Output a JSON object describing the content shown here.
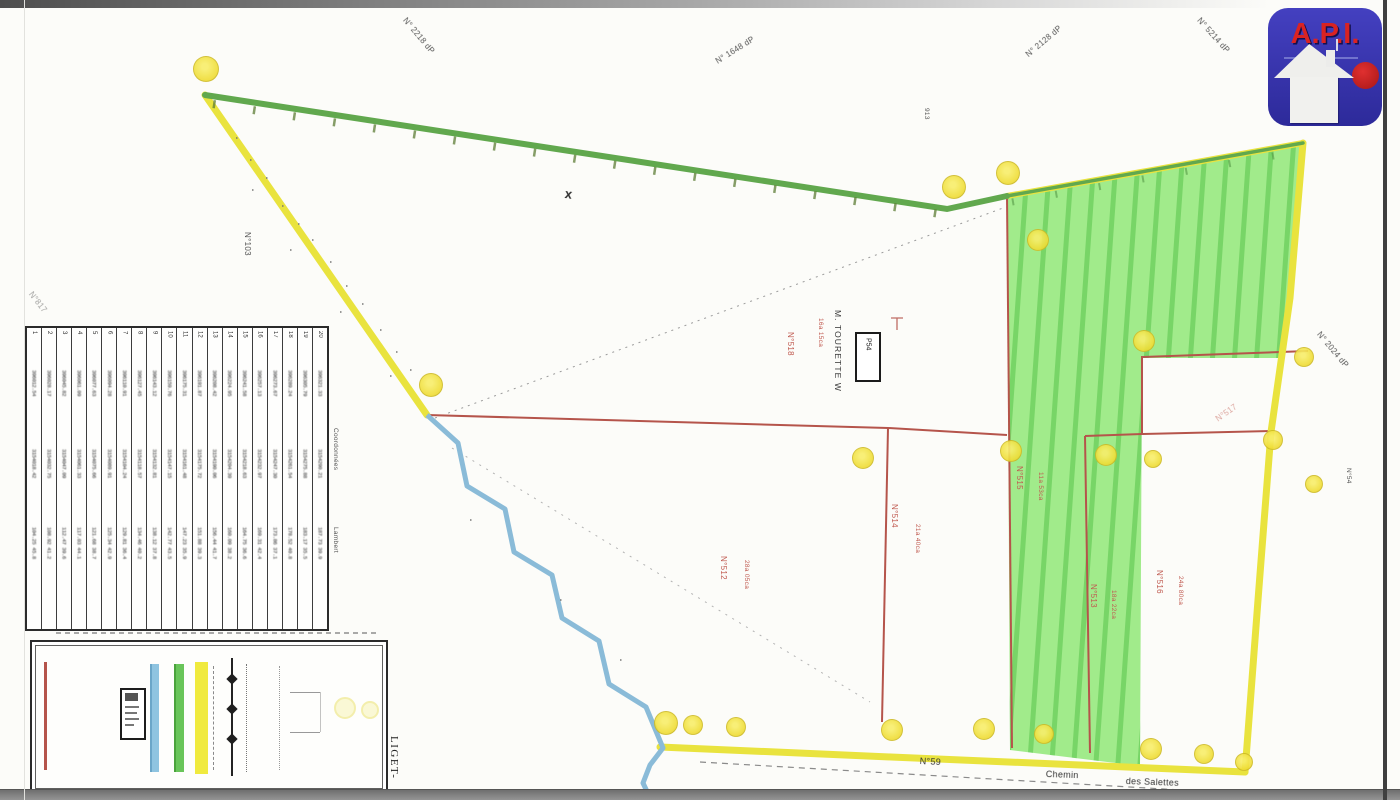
{
  "logo": {
    "text": "A.P.I."
  },
  "boxed_label": "P54",
  "labels": [
    {
      "text": "N° 2218 dP",
      "x": 408,
      "y": 16,
      "rot": 50,
      "cls": "g"
    },
    {
      "text": "N° 1648 dP",
      "x": 714,
      "y": 58,
      "rot": -32,
      "cls": "g"
    },
    {
      "text": "N° 2128 dP",
      "x": 1024,
      "y": 52,
      "rot": -40,
      "cls": "g"
    },
    {
      "text": "N° 5214 dP",
      "x": 1202,
      "y": 16,
      "rot": 48,
      "cls": "g"
    },
    {
      "text": "N° 2024 dP",
      "x": 1322,
      "y": 330,
      "rot": 50,
      "cls": "g"
    },
    {
      "text": "N°817",
      "x": 34,
      "y": 290,
      "rot": 52,
      "cls": "g faint"
    },
    {
      "text": "N°103",
      "x": 252,
      "y": 232,
      "rot": 90,
      "cls": "g"
    },
    {
      "text": "913",
      "x": 930,
      "y": 108,
      "rot": 90,
      "cls": "g sm"
    },
    {
      "text": "N°54",
      "x": 1352,
      "y": 468,
      "rot": 90,
      "cls": "g sm"
    },
    {
      "text": "M. TOURETTE W",
      "x": 843,
      "y": 310,
      "rot": 90,
      "cls": "owner"
    },
    {
      "text": "N°518",
      "x": 795,
      "y": 332,
      "rot": 90,
      "cls": "red"
    },
    {
      "text": "16a 15ca",
      "x": 824,
      "y": 318,
      "rot": 90,
      "cls": "red sm"
    },
    {
      "text": "N°512",
      "x": 728,
      "y": 556,
      "rot": 90,
      "cls": "red"
    },
    {
      "text": "28a 05ca",
      "x": 750,
      "y": 560,
      "rot": 90,
      "cls": "red sm"
    },
    {
      "text": "N°514",
      "x": 899,
      "y": 504,
      "rot": 90,
      "cls": "red"
    },
    {
      "text": "21a 40ca",
      "x": 921,
      "y": 524,
      "rot": 90,
      "cls": "red sm"
    },
    {
      "text": "N°515",
      "x": 1024,
      "y": 466,
      "rot": 90,
      "cls": "red"
    },
    {
      "text": "11a 53ca",
      "x": 1044,
      "y": 472,
      "rot": 90,
      "cls": "red sm"
    },
    {
      "text": "N°513",
      "x": 1098,
      "y": 584,
      "rot": 90,
      "cls": "red"
    },
    {
      "text": "18a 22ca",
      "x": 1117,
      "y": 590,
      "rot": 90,
      "cls": "red sm"
    },
    {
      "text": "N°516",
      "x": 1164,
      "y": 570,
      "rot": 90,
      "cls": "red"
    },
    {
      "text": "24a 80ca",
      "x": 1184,
      "y": 576,
      "rot": 90,
      "cls": "red sm"
    },
    {
      "text": "N°517",
      "x": 1214,
      "y": 416,
      "rot": -35,
      "cls": "red faint"
    },
    {
      "text": "N°59",
      "x": 920,
      "y": 756,
      "rot": 3,
      "cls": "dark md"
    },
    {
      "text": "Chemin",
      "x": 1046,
      "y": 769,
      "rot": 2,
      "cls": "dark md"
    },
    {
      "text": "des Salettes",
      "x": 1126,
      "y": 776,
      "rot": 2,
      "cls": "dark md"
    },
    {
      "text": "x",
      "x": 566,
      "y": 186,
      "rot": 8,
      "cls": "cross"
    },
    {
      "text": "Mur en limite",
      "x": 77,
      "y": 664,
      "rot": 90,
      "cls": "red"
    },
    {
      "text": "Mur non limite",
      "x": 102,
      "y": 662,
      "rot": 90,
      "cls": "dark"
    },
    {
      "text": "LIGET-",
      "x": 400,
      "y": 736,
      "rot": 90,
      "cls": "liget"
    },
    {
      "text": "N",
      "x": 310,
      "y": 780,
      "rot": 90,
      "cls": "north"
    },
    {
      "text": "Coordonnées",
      "x": 339,
      "y": 428,
      "rot": 90,
      "cls": "g sm"
    },
    {
      "text": "Lambert",
      "x": 339,
      "y": 527,
      "rot": 90,
      "cls": "g sm"
    }
  ],
  "map": {
    "markers": [
      [
        205,
        68,
        12
      ],
      [
        430,
        384,
        11
      ],
      [
        953,
        186,
        11
      ],
      [
        1007,
        172,
        11
      ],
      [
        1037,
        239,
        10
      ],
      [
        1143,
        340,
        10
      ],
      [
        1303,
        356,
        9
      ],
      [
        1272,
        439,
        9
      ],
      [
        1313,
        483,
        8
      ],
      [
        862,
        457,
        10
      ],
      [
        1010,
        450,
        10
      ],
      [
        1105,
        454,
        10
      ],
      [
        1152,
        458,
        8
      ],
      [
        665,
        722,
        11
      ],
      [
        692,
        724,
        9
      ],
      [
        735,
        726,
        9
      ],
      [
        891,
        729,
        10
      ],
      [
        983,
        728,
        10
      ],
      [
        1043,
        733,
        9
      ],
      [
        1150,
        748,
        10
      ],
      [
        1203,
        753,
        9
      ],
      [
        1243,
        761,
        8
      ]
    ]
  },
  "table": {
    "columns": [
      {
        "id": "1",
        "b1": "396012.54",
        "b2": "3154018.42",
        "b3": "104.25 45.8"
      },
      {
        "id": "2",
        "b1": "396028.17",
        "b2": "3154032.75",
        "b3": "108.92 41.2"
      },
      {
        "id": "3",
        "b1": "396045.82",
        "b2": "3154047.09",
        "b3": "112.47 39.6"
      },
      {
        "id": "4",
        "b1": "396061.09",
        "b2": "3154061.33",
        "b3": "117.03 44.1"
      },
      {
        "id": "5",
        "b1": "396077.63",
        "b2": "3154075.66",
        "b3": "121.68 38.7"
      },
      {
        "id": "6",
        "b1": "396094.28",
        "b2": "3154089.91",
        "b3": "125.34 42.9"
      },
      {
        "id": "7",
        "b1": "396110.91",
        "b2": "3154104.24",
        "b3": "129.81 36.4"
      },
      {
        "id": "8",
        "b1": "396127.45",
        "b2": "3154118.57",
        "b3": "134.46 40.2"
      },
      {
        "id": "9",
        "b1": "396143.12",
        "b2": "3154132.81",
        "b3": "138.12 37.8"
      },
      {
        "id": "10",
        "b1": "396159.76",
        "b2": "3154147.15",
        "b3": "142.77 43.5"
      },
      {
        "id": "11",
        "b1": "396175.31",
        "b2": "3154161.48",
        "b3": "147.23 35.9"
      },
      {
        "id": "12",
        "b1": "396191.87",
        "b2": "3154175.72",
        "b3": "151.88 39.3"
      },
      {
        "id": "13",
        "b1": "396208.42",
        "b2": "3154190.06",
        "b3": "156.44 41.7"
      },
      {
        "id": "14",
        "b1": "396224.95",
        "b2": "3154204.39",
        "b3": "160.09 38.2"
      },
      {
        "id": "15",
        "b1": "396241.58",
        "b2": "3154218.63",
        "b3": "164.75 36.6"
      },
      {
        "id": "16",
        "b1": "396257.13",
        "b2": "3154232.97",
        "b3": "169.31 42.4"
      },
      {
        "id": "17",
        "b1": "396273.67",
        "b2": "3154247.30",
        "b3": "173.86 37.1"
      },
      {
        "id": "18",
        "b1": "396289.24",
        "b2": "3154261.54",
        "b3": "178.52 40.8"
      },
      {
        "id": "19",
        "b1": "396305.79",
        "b2": "3154275.88",
        "b3": "183.17 35.5"
      },
      {
        "id": "20",
        "b1": "396321.33",
        "b2": "3154290.21",
        "b3": "187.73 39.9"
      }
    ]
  }
}
